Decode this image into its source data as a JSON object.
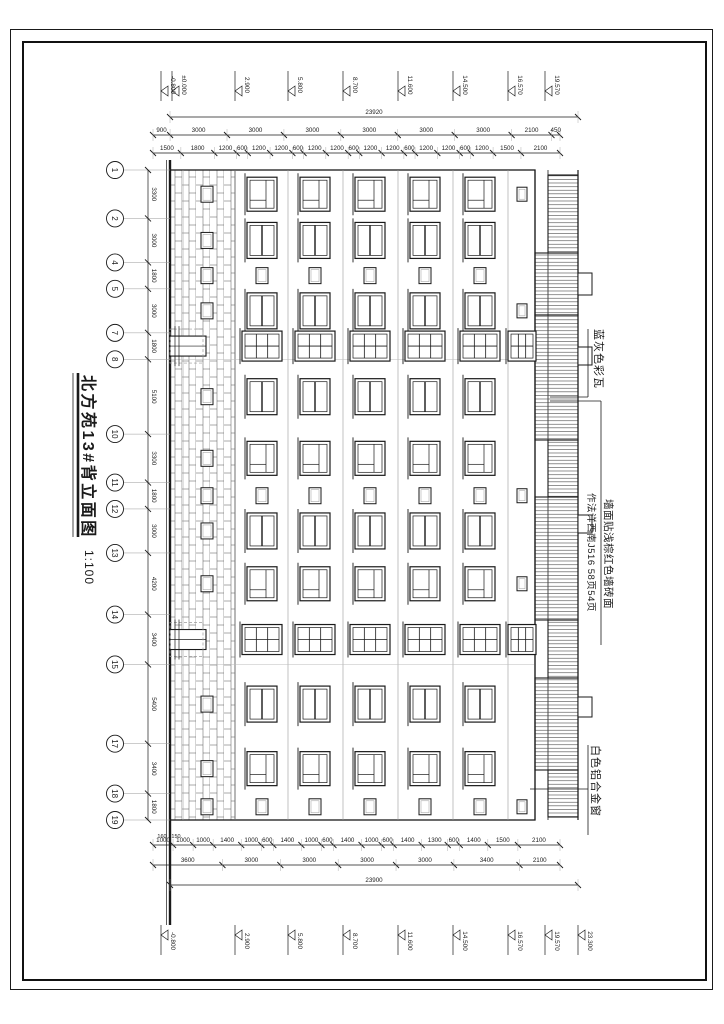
{
  "sheet": {
    "title": "北方苑13#背立面图",
    "scale": "1:100"
  },
  "annotations": {
    "roof_tile": "蓝灰色彩瓦",
    "wall_finish_line1": "墙面贴浅棕红色墙砖面",
    "wall_finish_line2": "作法详西南J516 58页54页",
    "window": "白色铝合金窗"
  },
  "axes": {
    "labels": [
      "1",
      "2",
      "4",
      "5",
      "7",
      "8",
      "10",
      "11",
      "12",
      "13",
      "14",
      "15",
      "17",
      "18",
      "19"
    ],
    "spacings": [
      3300,
      3000,
      1800,
      3000,
      1800,
      5100,
      3300,
      1800,
      3000,
      4200,
      3400,
      5400,
      3400,
      1800
    ]
  },
  "dims": {
    "left_detail": [
      "1500",
      "1800",
      "1200",
      "600",
      "1200",
      "1200",
      "600",
      "1200",
      "1200",
      "600",
      "1200",
      "1200",
      "600",
      "1200",
      "1200",
      "600",
      "1200",
      "1500",
      "2100"
    ],
    "left_floor": [
      "900",
      "3000",
      "3000",
      "3000",
      "3000",
      "3000",
      "3000",
      "2100",
      "450"
    ],
    "left_total": [
      "23920"
    ],
    "right_detail": [
      "1000",
      "1000",
      "1000",
      "1400",
      "1000",
      "600",
      "1400",
      "1000",
      "600",
      "1400",
      "1000",
      "600",
      "1400",
      "1300",
      "600",
      "1400",
      "1500",
      "2100"
    ],
    "right_group": [
      "3600",
      "3000",
      "3000",
      "3000",
      "3000",
      "3400",
      "2100"
    ],
    "right_total": [
      "23900"
    ],
    "right_offsets": [
      "150",
      "160"
    ]
  },
  "levels": {
    "left": [
      {
        "value": "-0.800",
        "y": 539
      },
      {
        "value": "±0.000",
        "y": 528
      },
      {
        "value": "2.900",
        "y": 465
      },
      {
        "value": "5.800",
        "y": 412
      },
      {
        "value": "8.700",
        "y": 357
      },
      {
        "value": "11.600",
        "y": 302
      },
      {
        "value": "14.500",
        "y": 247
      },
      {
        "value": "16.570",
        "y": 192
      },
      {
        "value": "19.570",
        "y": 155
      }
    ],
    "right": [
      {
        "value": "-0.800",
        "y": 539
      },
      {
        "value": "2.900",
        "y": 465
      },
      {
        "value": "5.800",
        "y": 412
      },
      {
        "value": "8.700",
        "y": 357
      },
      {
        "value": "11.600",
        "y": 302
      },
      {
        "value": "14.500",
        "y": 247
      },
      {
        "value": "16.570",
        "y": 192
      },
      {
        "value": "19.570",
        "y": 155
      },
      {
        "value": "23.300",
        "y": 122
      }
    ]
  },
  "drawing": {
    "canvas": {
      "w": 935,
      "h": 670
    },
    "colors": {
      "line": "#1a1a1a",
      "light": "#9a9a9a",
      "hatch": "#4a4a4a",
      "faint": "#bbbbbb"
    },
    "layout": {
      "x0": 125,
      "x1": 775,
      "ground": 530,
      "plinth": 517,
      "slabs": [
        465,
        412,
        357,
        302,
        247,
        192
      ],
      "eave": 165,
      "roof_top": 152,
      "ridge": 122,
      "floor_centers": [
        438,
        385,
        330,
        275,
        220
      ],
      "attic_center": 178,
      "ground_center": 493
    },
    "bay_types": [
      "A",
      "B",
      "C",
      "B",
      "D",
      "B",
      "A",
      "C",
      "B",
      "A",
      "D",
      "B",
      "A",
      "C"
    ],
    "attic_small_bays": [
      0,
      3,
      7,
      9,
      13
    ],
    "roof_segments": [
      {
        "x": 130,
        "w": 78,
        "tall": false
      },
      {
        "x": 208,
        "w": 62,
        "tall": true
      },
      {
        "x": 270,
        "w": 125,
        "tall": true
      },
      {
        "x": 395,
        "w": 57,
        "tall": false
      },
      {
        "x": 452,
        "w": 123,
        "tall": true
      },
      {
        "x": 575,
        "w": 58,
        "tall": false
      },
      {
        "x": 633,
        "w": 92,
        "tall": true
      },
      {
        "x": 725,
        "w": 47,
        "tall": false
      }
    ],
    "chimneys": [
      {
        "x": 228,
        "w": 22
      },
      {
        "x": 302,
        "w": 18
      },
      {
        "x": 470,
        "w": 18
      },
      {
        "x": 652,
        "w": 20
      }
    ]
  }
}
